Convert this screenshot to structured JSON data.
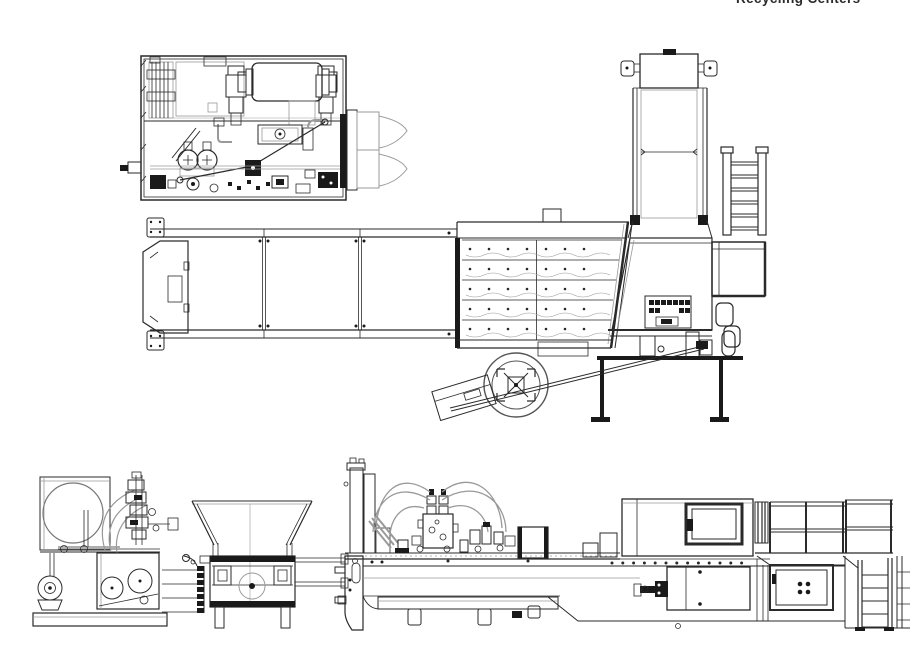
{
  "page": {
    "header_text": "Recycling Centers"
  },
  "colors": {
    "bg": "#ffffff",
    "line": "#2a2a2a",
    "line-light": "#9a9a9a",
    "fill-dark": "#1a1a1a"
  }
}
